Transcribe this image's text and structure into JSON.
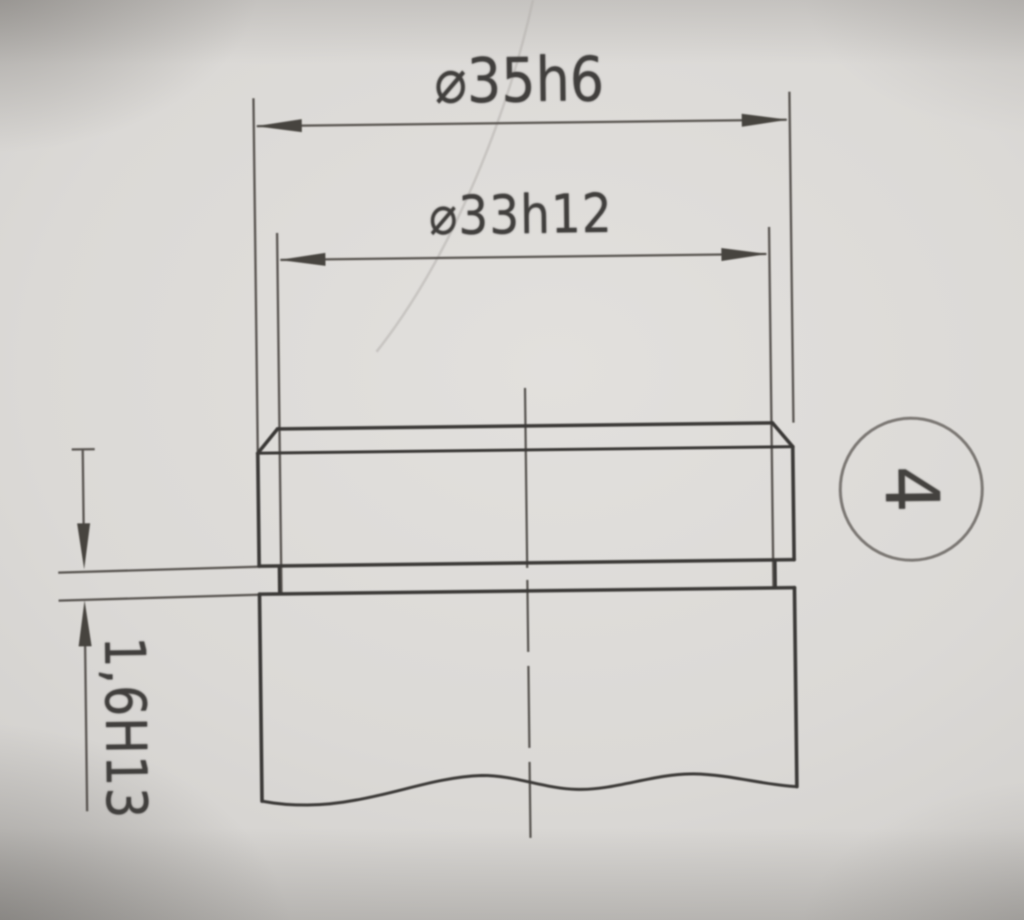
{
  "drawing": {
    "dimensions": [
      {
        "id": "outer-diameter",
        "label": "⌀35h6"
      },
      {
        "id": "groove-diameter",
        "label": "⌀33h12"
      },
      {
        "id": "groove-width",
        "label": "1,6H13"
      }
    ],
    "balloon": {
      "number": "4"
    },
    "colors": {
      "paper": "#d8d6d3",
      "outline_ink": "#3a3836",
      "thin_ink": "#55524e",
      "balloon_ring": "#7b7773"
    }
  }
}
